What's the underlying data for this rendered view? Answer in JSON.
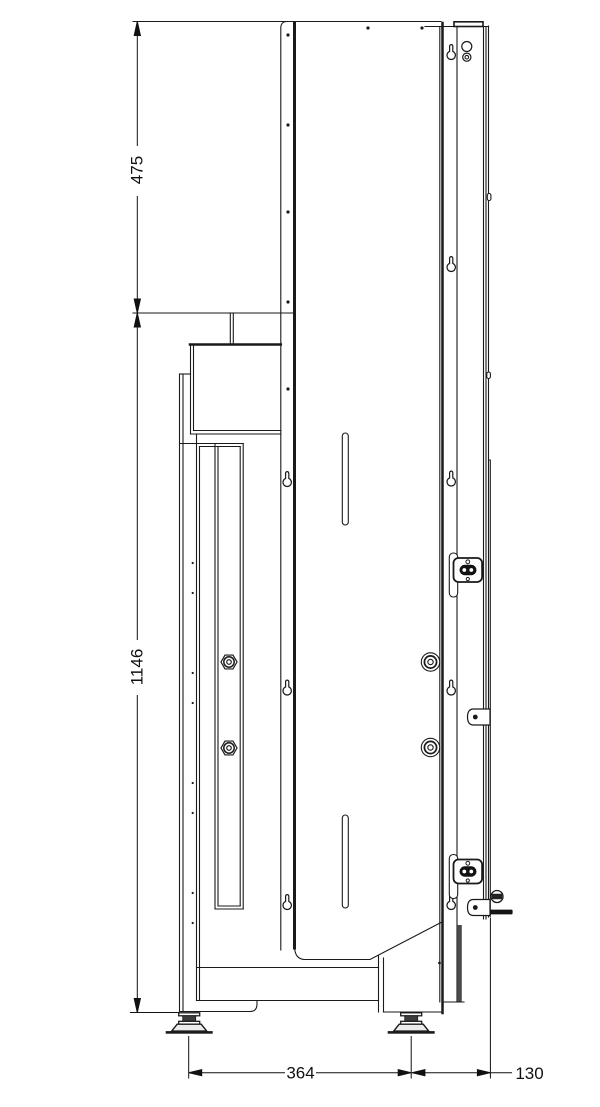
{
  "drawing": {
    "name": "cabinet-side-elevation",
    "view": "side elevation technical drawing",
    "line_color": "#1a1a1a",
    "background": "#ffffff",
    "dimensions": {
      "d475": {
        "label": "475",
        "value": 475,
        "axis": "vertical"
      },
      "d1146": {
        "label": "1146",
        "value": 1146,
        "axis": "vertical"
      },
      "d364": {
        "label": "364",
        "value": 364,
        "axis": "horizontal"
      },
      "d130": {
        "label": "130",
        "value": 130,
        "axis": "horizontal"
      }
    }
  }
}
